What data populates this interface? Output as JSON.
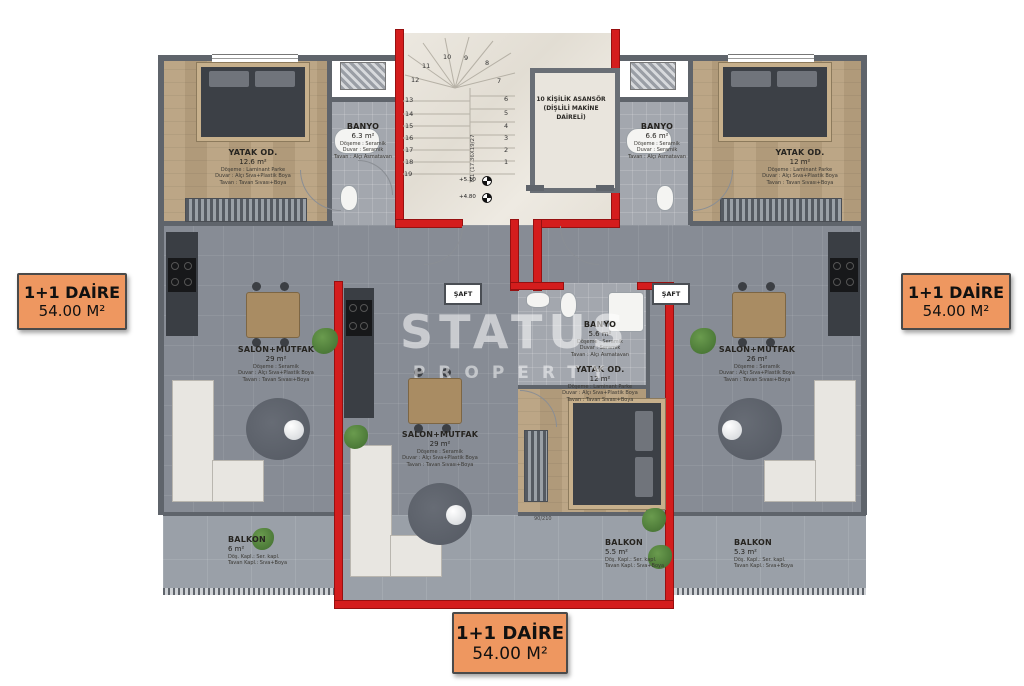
{
  "watermark": {
    "line1": "STATUS",
    "line2": "PROPERTY"
  },
  "tags": {
    "left": {
      "title": "1+1 DAİRE",
      "area": "54.00 M²"
    },
    "right": {
      "title": "1+1 DAİRE",
      "area": "54.00 M²"
    },
    "bottom": {
      "title": "1+1 DAİRE",
      "area": "54.00 M²"
    }
  },
  "colors": {
    "accent_red": "#d41d1d",
    "tag_orange": "#ee9760",
    "wall_gray": "#5f646b"
  },
  "stairs": {
    "numbers": [
      "1",
      "2",
      "3",
      "4",
      "5",
      "6",
      "7",
      "8",
      "9",
      "10",
      "11",
      "12",
      "13",
      "14",
      "15",
      "16",
      "17",
      "18",
      "19"
    ],
    "flight_label": "M1 (17.36X19/27",
    "elevation_upper": "+5.10",
    "elevation_lower": "+4.80"
  },
  "elevator": {
    "label": "10 KİŞİLİK ASANSÖR (DİŞLİLİ MAKİNE DAİRELİ)"
  },
  "shaft_label": "ŞAFT",
  "door_size": "90/210",
  "finishes": {
    "bedroom": [
      "Döşeme : Laminant Parke",
      "Duvar : Alçı Sıva+Plastik Boya",
      "Tavan : Tavan Sıvası+Boya"
    ],
    "bathroom": [
      "Döşeme : Seramik",
      "Duvar : Seramik",
      "Tavan : Alçı Asmatavan"
    ],
    "salon": [
      "Döşeme : Seramik",
      "Duvar : Alçı Sıva+Plastik Boya",
      "Tavan : Tavan Sıvası+Boya"
    ],
    "balcony": [
      "Döş. Kapl.: Ser. kapl.",
      "Tavan Kapl.: Sıva+Boya"
    ]
  },
  "rooms": {
    "bedroom_left": {
      "name": "YATAK OD.",
      "area": "12.6 m²"
    },
    "bathroom_left": {
      "name": "BANYO",
      "area": "6.3 m²"
    },
    "salon_left": {
      "name": "SALON+MUTFAK",
      "area": "29 m²"
    },
    "balcony_left": {
      "name": "BALKON",
      "area": "6 m²"
    },
    "salon_mid": {
      "name": "SALON+MUTFAK",
      "area": "29 m²"
    },
    "bathroom_mid": {
      "name": "BANYO",
      "area": "5.6 m²"
    },
    "bedroom_mid": {
      "name": "YATAK OD.",
      "area": "12 m²"
    },
    "balcony_mid": {
      "name": "BALKON",
      "area": "5.5 m²"
    },
    "bathroom_right": {
      "name": "BANYO",
      "area": "6.6 m²"
    },
    "bedroom_right": {
      "name": "YATAK OD.",
      "area": "12 m²"
    },
    "salon_right": {
      "name": "SALON+MUTFAK",
      "area": "26 m²"
    },
    "balcony_right": {
      "name": "BALKON",
      "area": "5.3 m²"
    }
  }
}
